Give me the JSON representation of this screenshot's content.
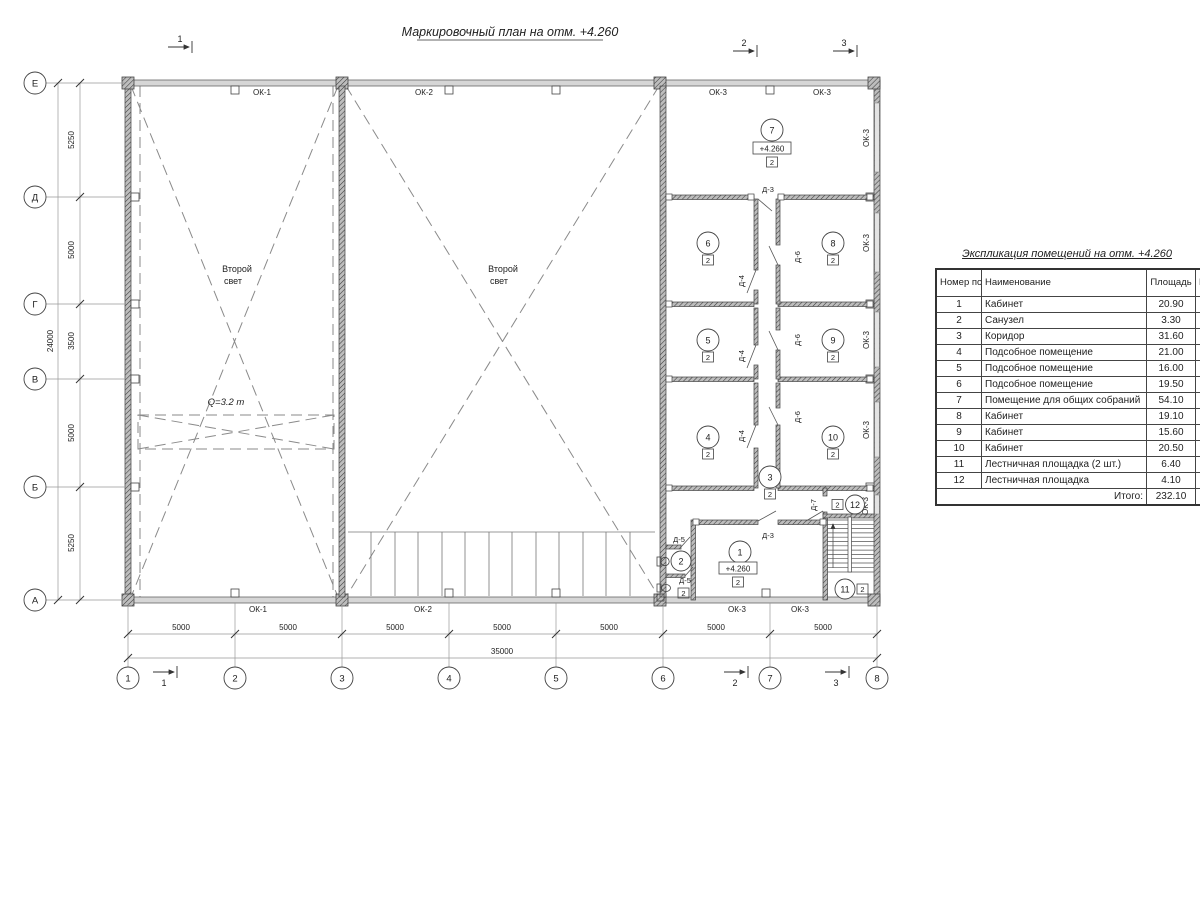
{
  "title": "Маркировочный план на отм. +4.260",
  "labels": {
    "ok1": "ОК-1",
    "ok2": "ОК-2",
    "ok3": "ОК-3",
    "d3": "Д-3",
    "d4": "Д-4",
    "d5": "Д-5",
    "d6": "Д-6",
    "d7": "Д-7",
    "cat": "2",
    "level": "+4.260",
    "sl1": "Второй",
    "sl2": "свет",
    "crane": "Q=3.2 т"
  },
  "rooms": {
    "r1": "1",
    "r2": "2",
    "r3": "3",
    "r4": "4",
    "r5": "5",
    "r6": "6",
    "r7": "7",
    "r8": "8",
    "r9": "9",
    "r10": "10",
    "r11": "11",
    "r12": "12"
  },
  "axes_h": [
    "1",
    "2",
    "3",
    "4",
    "5",
    "6",
    "7",
    "8"
  ],
  "axes_v": [
    "Е",
    "Д",
    "Г",
    "В",
    "Б",
    "А"
  ],
  "sections": [
    "1",
    "2",
    "3"
  ],
  "dims": {
    "left": [
      "5250",
      "5000",
      "3500",
      "5000",
      "5250"
    ],
    "left_total": "24000",
    "bottom": [
      "5000",
      "5000",
      "5000",
      "5000",
      "5000",
      "5000",
      "5000"
    ],
    "bottom_total": "35000"
  },
  "table": {
    "title": "Экспликация помещений на отм. +4.260",
    "headers": {
      "num": "Номер помещ.",
      "name": "Наименование",
      "area": "Площадь",
      "cat": "Кат. пом."
    },
    "rows": [
      {
        "num": "1",
        "name": "Кабинет",
        "area": "20.90"
      },
      {
        "num": "2",
        "name": "Санузел",
        "area": "3.30"
      },
      {
        "num": "3",
        "name": "Коридор",
        "area": "31.60"
      },
      {
        "num": "4",
        "name": "Подсобное помещение",
        "area": "21.00"
      },
      {
        "num": "5",
        "name": "Подсобное помещение",
        "area": "16.00"
      },
      {
        "num": "6",
        "name": "Подсобное помещение",
        "area": "19.50"
      },
      {
        "num": "7",
        "name": "Помещение для общих собраний",
        "area": "54.10"
      },
      {
        "num": "8",
        "name": "Кабинет",
        "area": "19.10"
      },
      {
        "num": "9",
        "name": "Кабинет",
        "area": "15.60"
      },
      {
        "num": "10",
        "name": "Кабинет",
        "area": "20.50"
      },
      {
        "num": "11",
        "name": "Лестничная площадка (2 шт.)",
        "area": "6.40"
      },
      {
        "num": "12",
        "name": "Лестничная площадка",
        "area": "4.10"
      }
    ],
    "total_label": "Итого:",
    "total_value": "232.10"
  }
}
